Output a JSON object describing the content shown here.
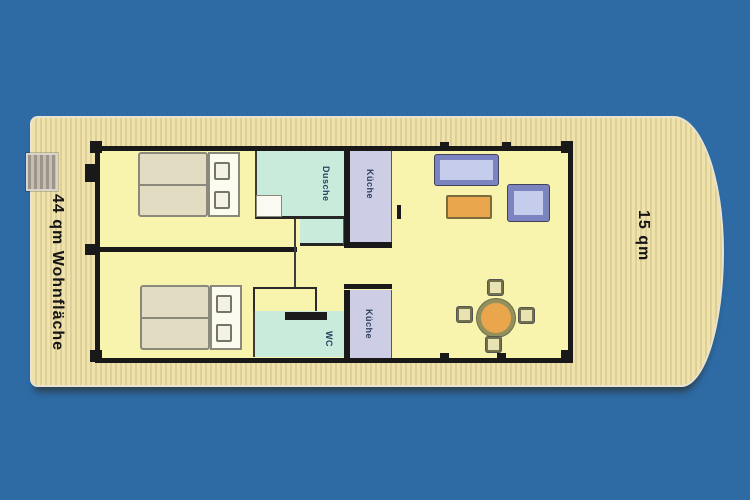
{
  "labels": {
    "living_space": "44 qm Wohnfläche",
    "terrace": "15 qm",
    "shower": "Dusche",
    "kitchen_upper": "Küche",
    "wc": "WC",
    "kitchen_lower": "Küche"
  },
  "rooms": [
    {
      "name": "bedroom-upper",
      "label": ""
    },
    {
      "name": "bedroom-lower",
      "label": ""
    },
    {
      "name": "shower",
      "label": "Dusche"
    },
    {
      "name": "kitchen-upper",
      "label": "Küche"
    },
    {
      "name": "wc",
      "label": "WC"
    },
    {
      "name": "kitchen-lower",
      "label": "Küche"
    },
    {
      "name": "living-dining-area",
      "label": ""
    },
    {
      "name": "bow-terrace",
      "label": "15 qm"
    }
  ],
  "furniture": [
    {
      "name": "double-bed-upper"
    },
    {
      "name": "double-bed-lower"
    },
    {
      "name": "sofa"
    },
    {
      "name": "coffee-table"
    },
    {
      "name": "armchair"
    },
    {
      "name": "dining-table"
    },
    {
      "name": "dining-chairs",
      "count": 4
    },
    {
      "name": "gangway-steps"
    }
  ],
  "colors": {
    "background": "#2e6ba5",
    "deck": "#efe2ab",
    "deck_stripe": "#ddcf97",
    "floor": "#f8f4ae",
    "wall": "#191919",
    "wet_room": "#c9ebdb",
    "kitchen": "#cdcee5",
    "label_text": "#2c3f5e",
    "furniture_blue_border": "#7b84bf",
    "furniture_blue_fill": "#c6cceb",
    "table_orange": "#eaa64c",
    "chair_fill": "#e9e2b4",
    "bed_fill": "#e2dcc2",
    "white": "#fcfbf0"
  }
}
